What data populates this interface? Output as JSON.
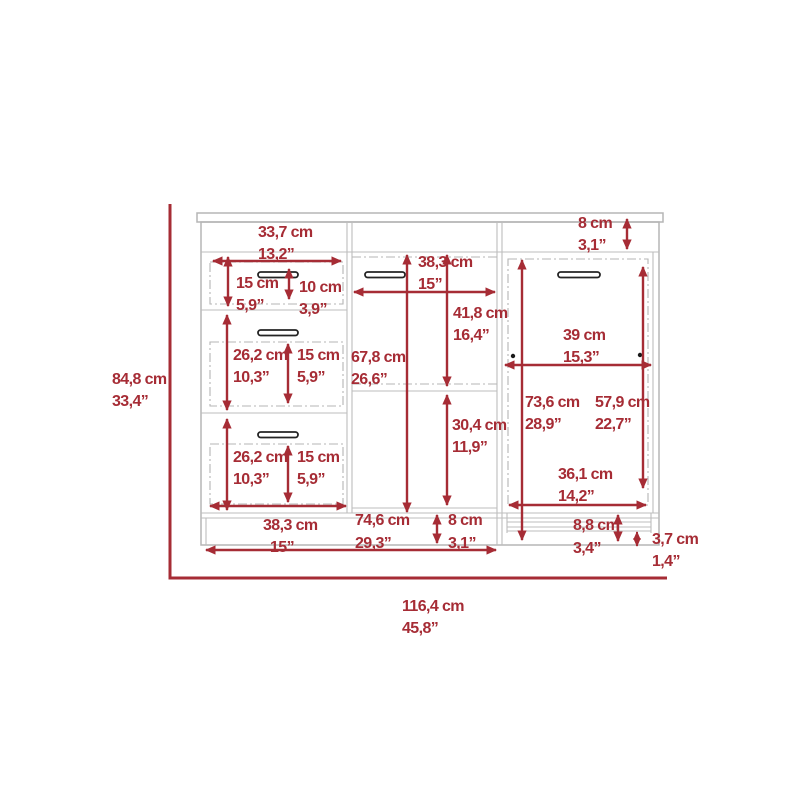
{
  "diagram": {
    "colors": {
      "dimension_red": "#A62C35",
      "furniture_gray": "#b5b5b5",
      "handle_dark": "#242424",
      "background": "#ffffff"
    },
    "overall": {
      "height": {
        "cm": "84,8 cm",
        "in": "33,4”"
      },
      "width": {
        "cm": "116,4 cm",
        "in": "45,8”"
      }
    },
    "dims": {
      "top_width": {
        "cm": "33,7 cm",
        "in": "13,2”"
      },
      "top_rail_height": {
        "cm": "8 cm",
        "in": "3,1”"
      },
      "drawer1_front_height": {
        "cm": "15 cm",
        "in": "5,9”"
      },
      "drawer1_inner_height": {
        "cm": "10 cm",
        "in": "3,9”"
      },
      "drawer2_front_height": {
        "cm": "26,2 cm",
        "in": "10,3”"
      },
      "drawer2_inner_height": {
        "cm": "15 cm",
        "in": "5,9”"
      },
      "drawer3_front_height": {
        "cm": "26,2 cm",
        "in": "10,3”"
      },
      "drawer3_inner_height": {
        "cm": "15 cm",
        "in": "5,9”"
      },
      "left_column_width": {
        "cm": "38,3 cm",
        "in": "15”"
      },
      "middle_column_width": {
        "cm": "38,3 cm",
        "in": "15”"
      },
      "middle_upper_opening_height": {
        "cm": "41,8 cm",
        "in": "16,4”"
      },
      "middle_total_opening_height": {
        "cm": "67,8 cm",
        "in": "26,6”"
      },
      "middle_lower_opening_height": {
        "cm": "30,4 cm",
        "in": "11,9”"
      },
      "left_middle_width": {
        "cm": "74,6 cm",
        "in": "29,3”"
      },
      "base_height_middle": {
        "cm": "8 cm",
        "in": "3,1”"
      },
      "door_width": {
        "cm": "39 cm",
        "in": "15,3”"
      },
      "door_total_height": {
        "cm": "73,6 cm",
        "in": "28,9”"
      },
      "door_panel_height": {
        "cm": "57,9 cm",
        "in": "22,7”"
      },
      "door_opening_width": {
        "cm": "36,1 cm",
        "in": "14,2”"
      },
      "base_height_right": {
        "cm": "8,8 cm",
        "in": "3,4”"
      },
      "kickplate_height": {
        "cm": "3,7 cm",
        "in": "1,4”"
      }
    }
  }
}
